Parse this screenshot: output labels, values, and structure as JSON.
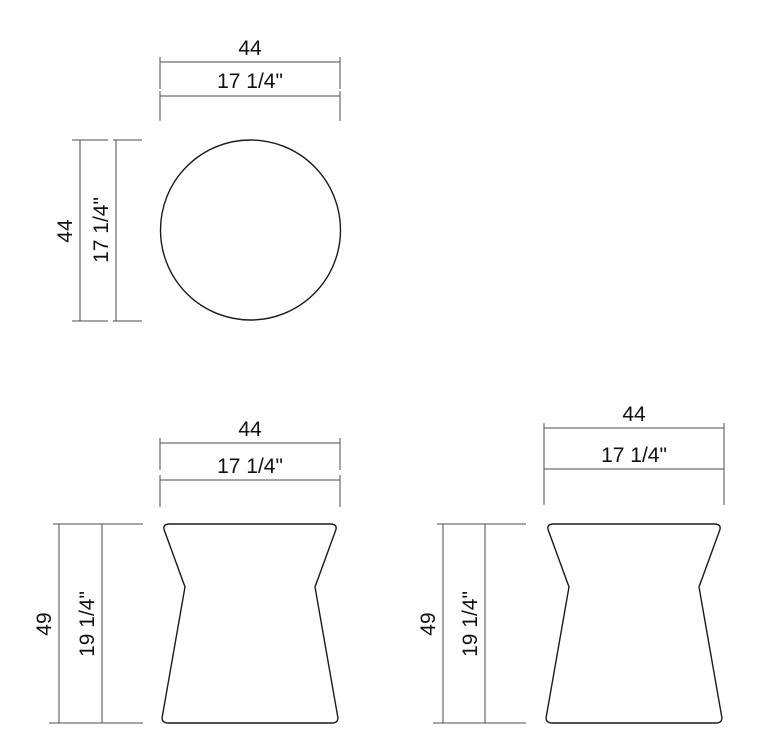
{
  "drawing_type": "furniture-dimension-drawing",
  "views": {
    "top": {
      "width_cm": "44",
      "width_in": "17 1/4\"",
      "depth_cm": "44",
      "depth_in": "17 1/4\""
    },
    "front": {
      "width_cm": "44",
      "width_in": "17 1/4\"",
      "height_cm": "49",
      "height_in": "19 1/4\""
    },
    "side": {
      "width_cm": "44",
      "width_in": "17 1/4\"",
      "height_cm": "49",
      "height_in": "19 1/4\""
    }
  },
  "colors": {
    "background": "#ffffff",
    "dimension_line": "#4d4d4d",
    "outline": "#1a1a1a",
    "text": "#111111"
  }
}
